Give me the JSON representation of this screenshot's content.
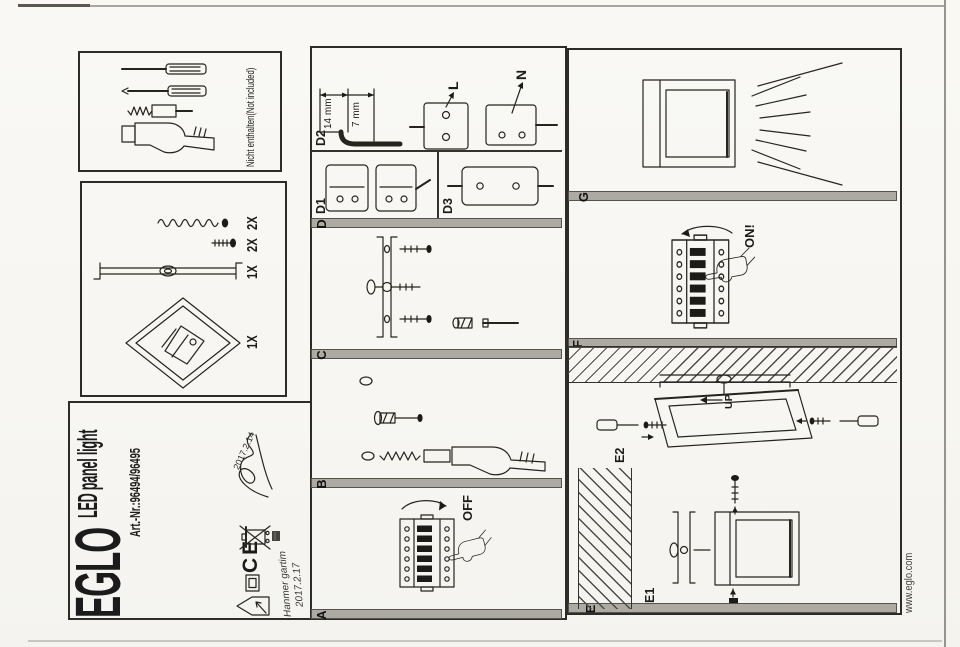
{
  "brand": {
    "name": "EGLO",
    "product": "LED panel light",
    "article": "Art.-Nr.:96494/96495",
    "website": "www.eglo.com"
  },
  "tools": {
    "note": "Nicht enthalten(Not included)"
  },
  "parts": {
    "panel_qty": "1X",
    "bracket_qty": "1X",
    "screw_qty": "2X",
    "anchor_qty": "2X"
  },
  "sections": {
    "a": "A",
    "b": "B",
    "c": "C",
    "d": "D",
    "e": "E",
    "f": "F",
    "g": "G"
  },
  "steps": {
    "d1": "D1",
    "d2": "D2",
    "d3": "D3",
    "e1": "E1",
    "e2": "E2"
  },
  "labels": {
    "off": "OFF",
    "on": "ON!",
    "up": "UP",
    "live": "L",
    "neutral": "N",
    "strip_outer": "14 mm",
    "strip_inner": "7 mm",
    "ce": "CE"
  },
  "handwriting": {
    "note_line1": "Hanmer gartim",
    "note_line2": "2017.2.17",
    "signature_date": "2017.2.14"
  }
}
